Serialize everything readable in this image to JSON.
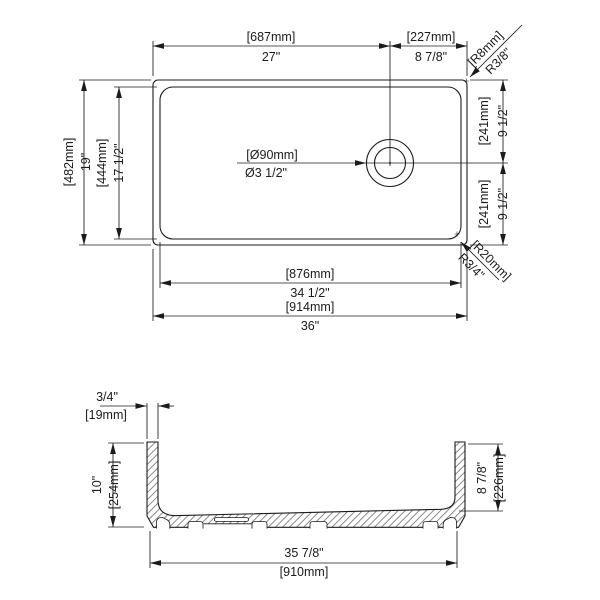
{
  "top": {
    "top_width": {
      "mm": "[687mm]",
      "in": "27\""
    },
    "drain_offset": {
      "mm": "[227mm]",
      "in": "8 7/8\""
    },
    "rim_corner_radius": {
      "mm": "[R8mm]",
      "in": "R3/8\""
    },
    "overall_depth": {
      "mm": "[482mm]",
      "in": "19\""
    },
    "basin_depth": {
      "mm": "[444mm]",
      "in": "17 1/2\""
    },
    "drain_diameter": {
      "mm": "[Ø90mm]",
      "in": "Ø3 1/2\""
    },
    "drain_to_top": {
      "mm": "[241mm]",
      "in": "9 1/2\""
    },
    "drain_to_bottom": {
      "mm": "[241mm]",
      "in": "9 1/2\""
    },
    "basin_corner_radius": {
      "mm": "[R20mm]",
      "in": "R3/4\""
    },
    "basin_length": {
      "mm": "[876mm]",
      "in": "34 1/2\""
    },
    "overall_length": {
      "mm": "[914mm]",
      "in": "36\""
    }
  },
  "section": {
    "rim_thickness": {
      "in": "3/4\"",
      "mm": "[19mm]"
    },
    "overall_height": {
      "in": "10\"",
      "mm": "[254mm]"
    },
    "basin_depth": {
      "in": "8 7/8\"",
      "mm": "[226mm]"
    },
    "base_length": {
      "in": "35 7/8\"",
      "mm": "[910mm]"
    }
  },
  "colors": {
    "line": "#1b1b1b",
    "background": "#ffffff"
  }
}
